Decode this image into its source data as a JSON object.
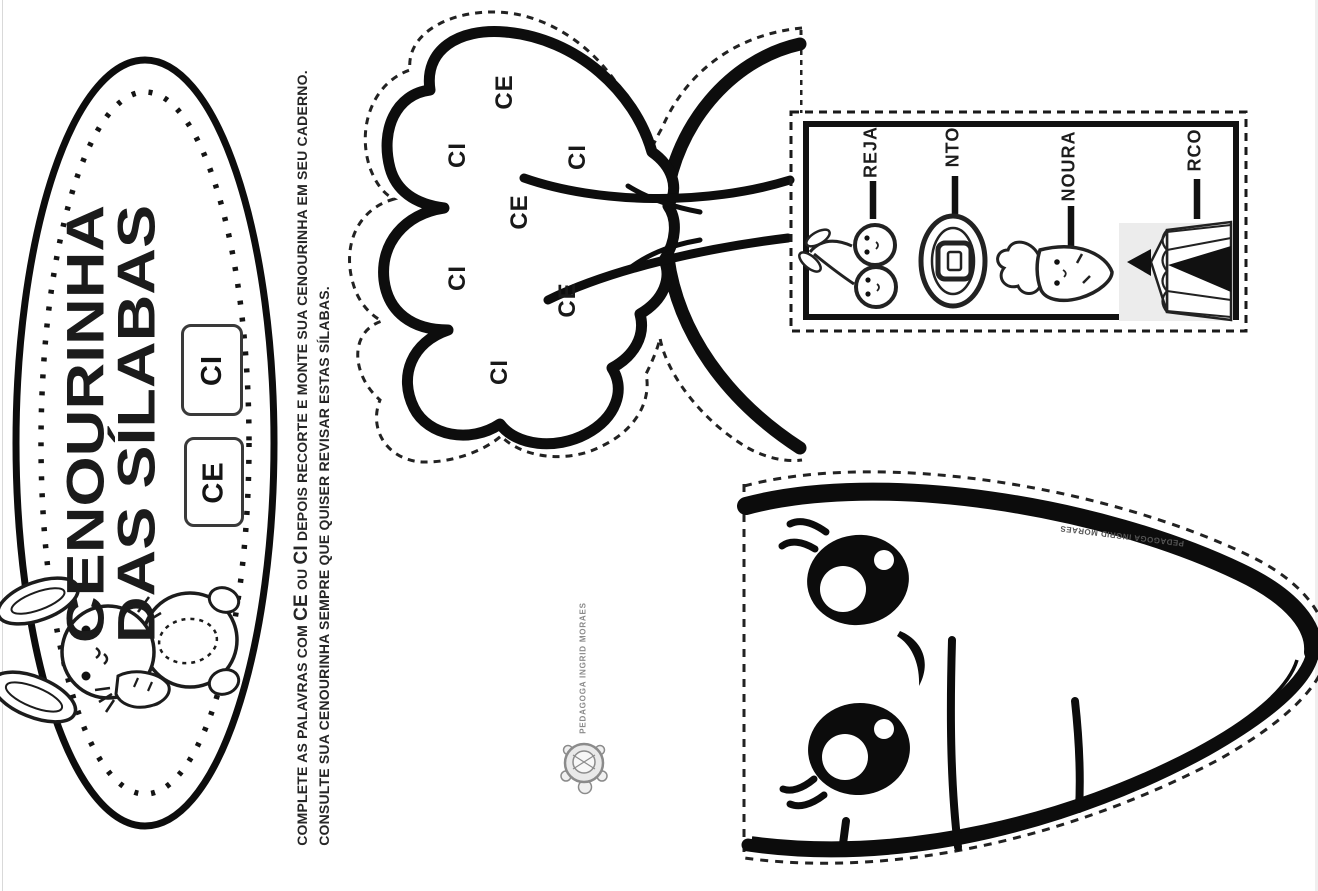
{
  "page": {
    "background": "#ffffff",
    "ink": "#111111",
    "tent_bg": "#ececec",
    "logo_gray": "#8a8a8a"
  },
  "badge": {
    "title_line1": "CENOURINHA",
    "title_line2": "DAS SÍLABAS",
    "syllable_box_1": "CE",
    "syllable_box_2": "CI",
    "bunny_icon": "bunny-holding-carrot"
  },
  "instructions": {
    "line1_part1": "COMPLETE AS PALAVRAS COM ",
    "line1_ce": "CE",
    "line1_part2": " OU ",
    "line1_ci": "CI",
    "line1_part3": " DEPOIS RECORTE E MONTE SUA CENOURINHA EM SEU CADERNO.",
    "line2": "CONSULTE SUA CENOURINHA SEMPRE QUE QUISER REVISAR ESTAS SÍLABAS."
  },
  "carrot_top_piece": {
    "syllables": [
      "CE",
      "CI",
      "CI",
      "CE",
      "CI",
      "CE",
      "CI"
    ]
  },
  "word_cards": {
    "items": [
      {
        "ending": "REJA",
        "image": "cherries"
      },
      {
        "ending": "NTO",
        "image": "belt"
      },
      {
        "ending": "NOURA",
        "image": "carrot"
      },
      {
        "ending": "RCO",
        "image": "circus-tent"
      }
    ]
  },
  "carrot_body_piece": {
    "credit": "PEDAGOGA INGRID MORAES"
  },
  "logo": {
    "text": "PEDAGOGA INGRID MORAES",
    "icon": "turtle"
  }
}
